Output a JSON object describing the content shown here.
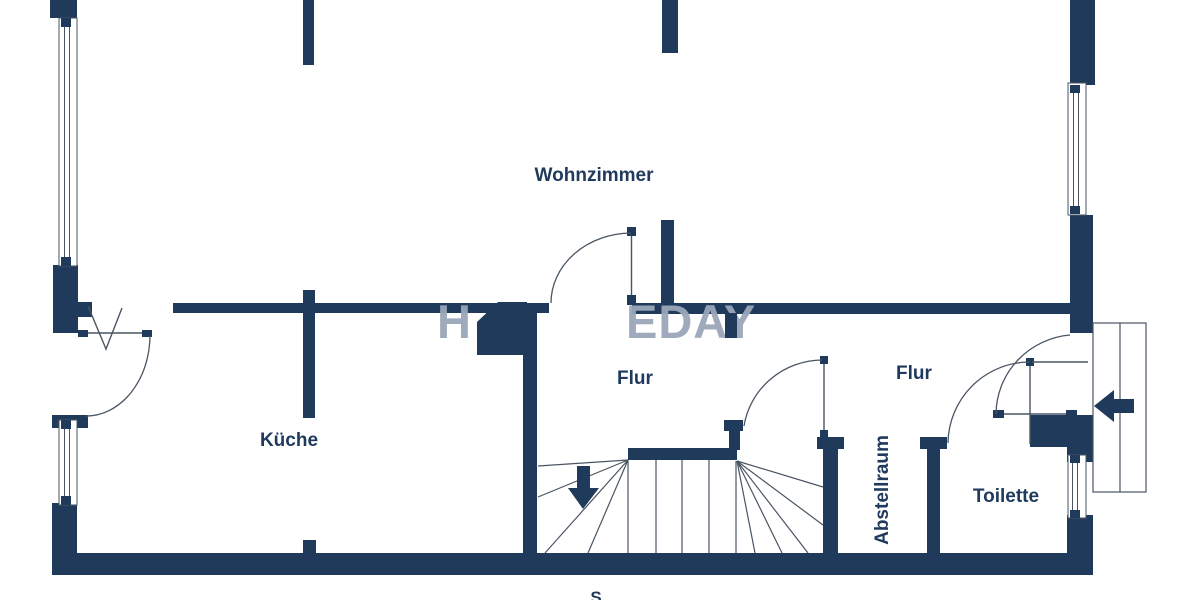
{
  "colors": {
    "wall": "#1f3a5a",
    "line": "#4a5563",
    "text": "#1f3a5c",
    "watermark": "#9aa7b9",
    "background": "#ffffff"
  },
  "rooms": {
    "wohnzimmer": "Wohnzimmer",
    "kueche": "Küche",
    "flur_left": "Flur",
    "flur_right": "Flur",
    "abstellraum": "Abstellraum",
    "toilette": "Toilette"
  },
  "compass": {
    "south": "S"
  },
  "watermark": {
    "brand_fragment": "EDAY",
    "logo_fragment": "H"
  }
}
